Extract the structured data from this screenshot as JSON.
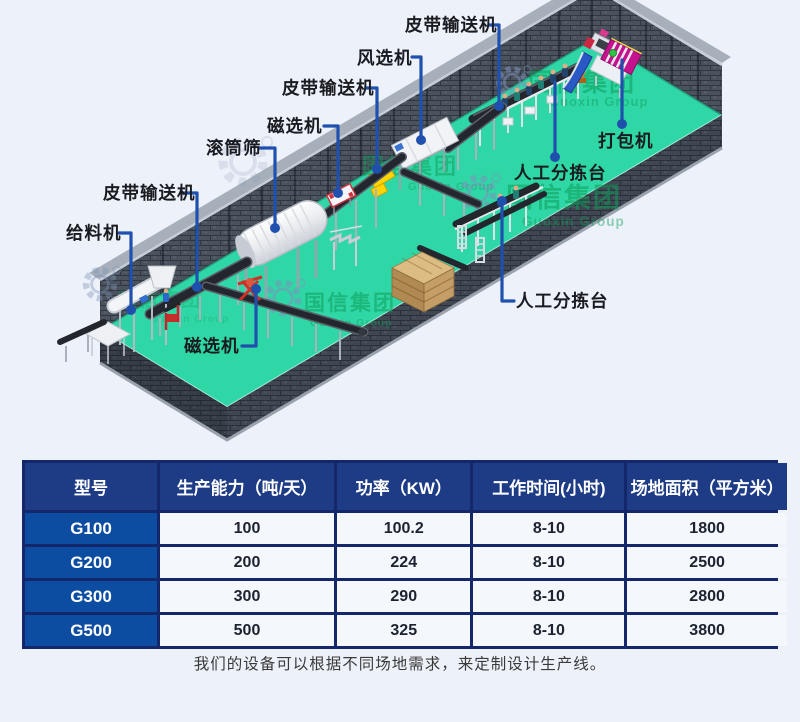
{
  "diagram": {
    "labels": [
      {
        "id": "belt-conveyor-top",
        "text": "皮带输送机"
      },
      {
        "id": "air-separator",
        "text": "风选机"
      },
      {
        "id": "belt-conveyor-mid",
        "text": "皮带输送机"
      },
      {
        "id": "magnetic-separator-top",
        "text": "磁选机"
      },
      {
        "id": "drum-screen",
        "text": "滚筒筛"
      },
      {
        "id": "belt-conveyor-left",
        "text": "皮带输送机"
      },
      {
        "id": "feeder",
        "text": "给料机"
      },
      {
        "id": "magnetic-separator-btm",
        "text": "磁选机"
      },
      {
        "id": "sorting-platform-btm",
        "text": "人工分拣台"
      },
      {
        "id": "sorting-platform-top",
        "text": "人工分拣台"
      },
      {
        "id": "baler",
        "text": "打包机"
      }
    ],
    "watermark": {
      "cn": "国信集团",
      "en": "Guoxin Group"
    },
    "colors": {
      "floor": "#30d7a6",
      "wall": "#4a525d",
      "leader_blue": "#2050ae",
      "watermark_green": "#0d9d58",
      "belt_black": "#23272d",
      "chute_yellow": "#ffd400",
      "baler_magenta": "#c5128f"
    }
  },
  "table": {
    "headers": [
      "型号",
      "生产能力（吨/天）",
      "功率（KW）",
      "工作时间(小时)",
      "场地面积（平方米）"
    ],
    "rows": [
      {
        "model": "G100",
        "capacity": "100",
        "power": "100.2",
        "hours": "8-10",
        "area": "1800"
      },
      {
        "model": "G200",
        "capacity": "200",
        "power": "224",
        "hours": "8-10",
        "area": "2500"
      },
      {
        "model": "G300",
        "capacity": "300",
        "power": "290",
        "hours": "8-10",
        "area": "2800"
      },
      {
        "model": "G500",
        "capacity": "500",
        "power": "325",
        "hours": "8-10",
        "area": "3800"
      }
    ]
  },
  "caption": "我们的设备可以根据不同场地需求，来定制设计生产线。"
}
